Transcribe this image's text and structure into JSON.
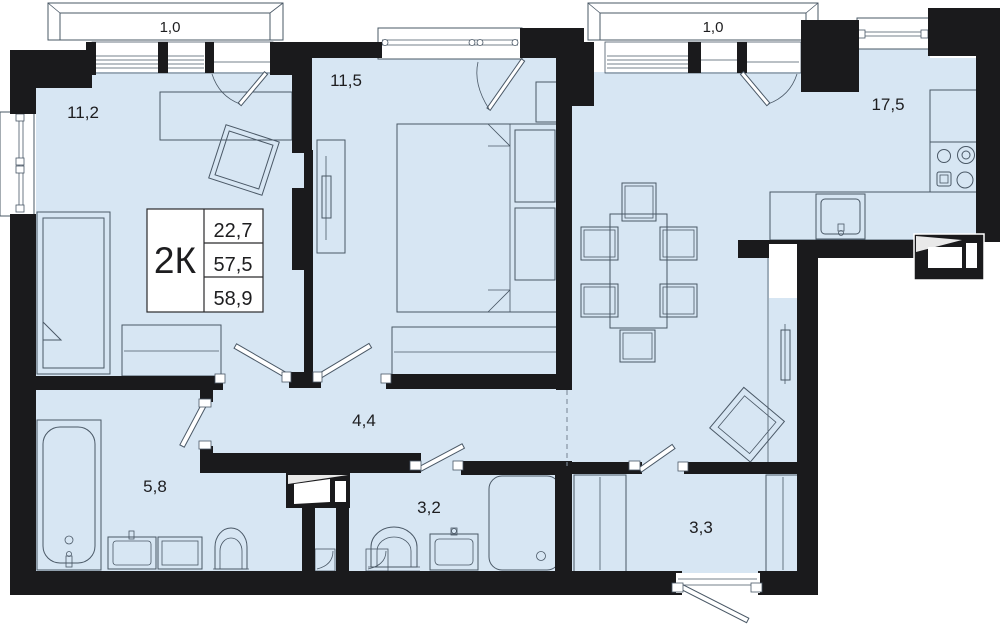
{
  "info_box": {
    "type_label": "2К",
    "values": [
      "22,7",
      "57,5",
      "58,9"
    ]
  },
  "labels": {
    "balcony_left": "1,0",
    "balcony_right": "1,0",
    "room_11_2": "11,2",
    "room_11_5": "11,5",
    "room_17_5": "17,5",
    "hall_4_4": "4,4",
    "bath_5_8": "5,8",
    "wc_3_2": "3,2",
    "hall_3_3": "3,3"
  },
  "colors": {
    "wall": "#1a1a1c",
    "floor": "#d7e6f3",
    "floor_light": "#e8f1fa",
    "line": "#4a5866",
    "background": "#ffffff"
  }
}
